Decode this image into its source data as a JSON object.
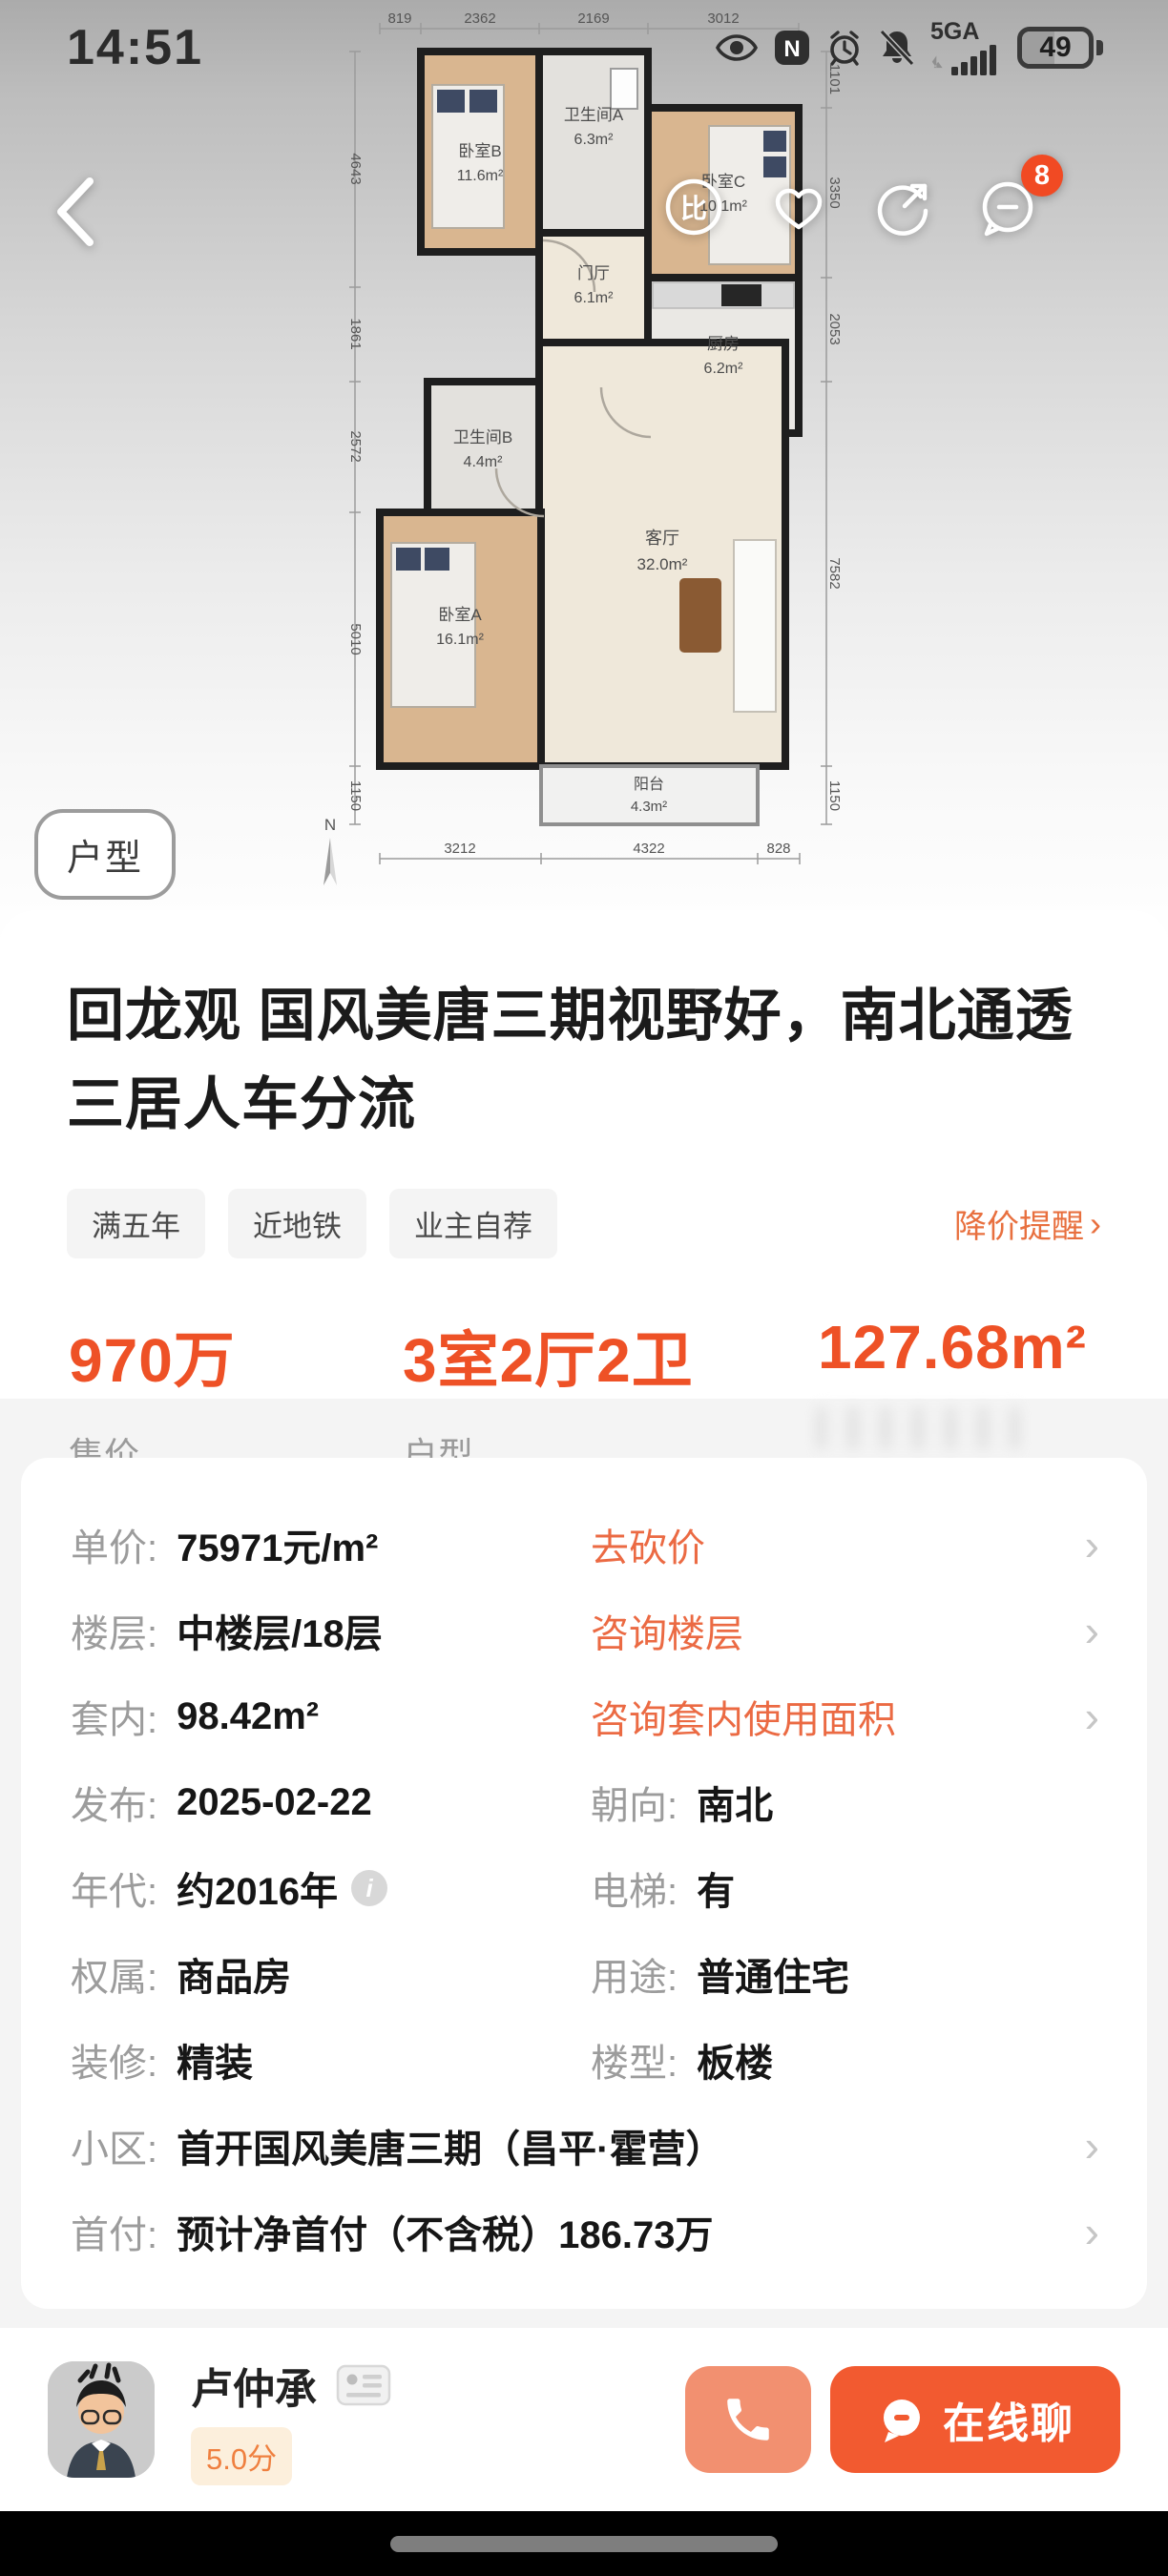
{
  "colors": {
    "accent_orange": "#EE5126",
    "link_orange": "#EB6A43",
    "button_orange": "#F25A30",
    "button_salmon": "#F29070",
    "badge_red": "#F14A23"
  },
  "status_bar": {
    "time": "14:51",
    "network": "5GA",
    "battery_percent": "49"
  },
  "nav": {
    "badge_count": "8",
    "compare_glyph": "比"
  },
  "plan": {
    "badge": "户型",
    "compass": "N",
    "rooms": [
      {
        "name": "卧室B",
        "area": "11.6m²"
      },
      {
        "name": "卫生间A",
        "area": "6.3m²"
      },
      {
        "name": "卧室C",
        "area": "10.1m²"
      },
      {
        "name": "门厅",
        "area": "6.1m²"
      },
      {
        "name": "厨房",
        "area": "6.2m²"
      },
      {
        "name": "卫生间B",
        "area": "4.4m²"
      },
      {
        "name": "客厅",
        "area": "32.0m²"
      },
      {
        "name": "卧室A",
        "area": "16.1m²"
      },
      {
        "name": "阳台",
        "area": "4.3m²"
      }
    ],
    "dims": {
      "top": [
        "819",
        "2362",
        "2169",
        "3012"
      ],
      "left": [
        "4643",
        "1861",
        "2572",
        "5010",
        "1150"
      ],
      "right": [
        "1101",
        "3350",
        "2053",
        "7582",
        "1150"
      ],
      "bottom": [
        "3212",
        "4322",
        "828"
      ]
    }
  },
  "listing": {
    "title": "回龙观 国风美唐三期视野好，南北通透三居人车分流",
    "tags": [
      "满五年",
      "近地铁",
      "业主自荐"
    ],
    "price_alert": "降价提醒",
    "price": {
      "value": "970万",
      "label": "售价"
    },
    "layout": {
      "value": "3室2厅2卫",
      "label": "户型"
    },
    "area": {
      "value": "127.68m²"
    }
  },
  "details": {
    "rows": [
      {
        "label": "单价:",
        "value": "75971元/m²",
        "link": "去砍价"
      },
      {
        "label": "楼层:",
        "value": "中楼层/18层",
        "link": "咨询楼层"
      },
      {
        "label": "套内:",
        "value": "98.42m²",
        "link": "咨询套内使用面积"
      },
      {
        "label": "发布:",
        "value": "2025-02-22",
        "label2": "朝向:",
        "value2": "南北"
      },
      {
        "label": "年代:",
        "value": "约2016年",
        "label2": "电梯:",
        "value2": "有"
      },
      {
        "label": "权属:",
        "value": "商品房",
        "label2": "用途:",
        "value2": "普通住宅"
      },
      {
        "label": "装修:",
        "value": "精装",
        "label2": "楼型:",
        "value2": "板楼"
      },
      {
        "label": "小区:",
        "value": "首开国风美唐三期（昌平·霍营）"
      },
      {
        "label": "首付:",
        "value": "预计净首付（不含税）186.73万"
      }
    ]
  },
  "agent": {
    "name": "卢仲承",
    "rating": "5.0分"
  },
  "actions": {
    "chat_label": "在线聊"
  }
}
